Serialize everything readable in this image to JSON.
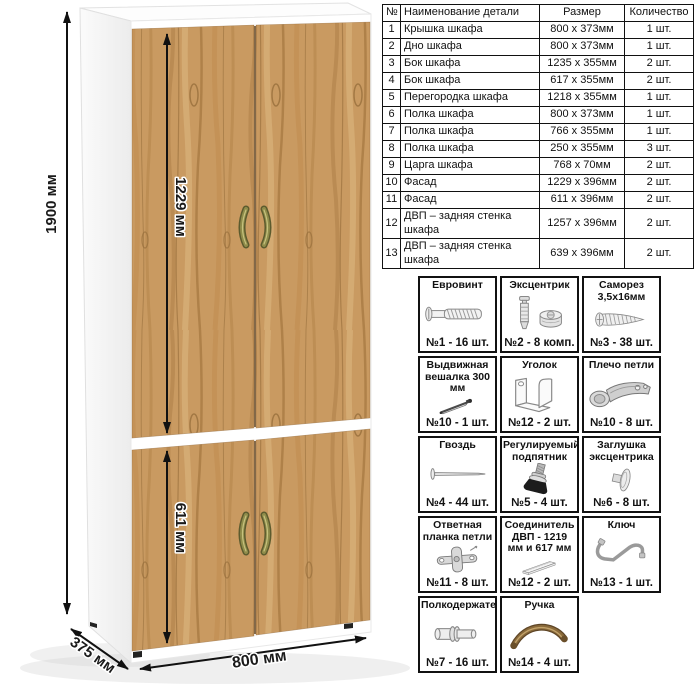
{
  "dimensions": {
    "height": "1900 мм",
    "upper_door": "1229 мм",
    "lower_door": "611 мм",
    "width": "800 мм",
    "depth": "375 мм"
  },
  "parts_table": {
    "headers": [
      "№",
      "Наименование детали",
      "Размер",
      "Количество"
    ],
    "rows": [
      [
        "1",
        "Крышка шкафа",
        "800 х 373мм",
        "1 шт."
      ],
      [
        "2",
        "Дно шкафа",
        "800 х 373мм",
        "1 шт."
      ],
      [
        "3",
        "Бок шкафа",
        "1235 х 355мм",
        "2 шт."
      ],
      [
        "4",
        "Бок шкафа",
        "617 х 355мм",
        "2 шт."
      ],
      [
        "5",
        "Перегородка шкафа",
        "1218 х 355мм",
        "1 шт."
      ],
      [
        "6",
        "Полка шкафа",
        "800 х 373мм",
        "1 шт."
      ],
      [
        "7",
        "Полка шкафа",
        "766 х 355мм",
        "1 шт."
      ],
      [
        "8",
        "Полка шкафа",
        "250 х 355мм",
        "3 шт."
      ],
      [
        "9",
        "Царга шкафа",
        "768 х 70мм",
        "2 шт."
      ],
      [
        "10",
        "Фасад",
        "1229 х 396мм",
        "2 шт."
      ],
      [
        "11",
        "Фасад",
        "611 х 396мм",
        "2 шт."
      ],
      [
        "12",
        "ДВП – задняя стенка шкафа",
        "1257 х 396мм",
        "2 шт."
      ],
      [
        "13",
        "ДВП – задняя стенка шкафа",
        "639 х 396мм",
        "2 шт."
      ]
    ]
  },
  "hardware": {
    "items": [
      {
        "title": "Евровинт",
        "count": "№1 - 16 шт.",
        "icon": "euroscrew"
      },
      {
        "title": "Эксцентрик",
        "count": "№2 - 8 комп.",
        "icon": "cam"
      },
      {
        "title": "Саморез 3,5х16мм",
        "count": "№3 - 38 шт.",
        "icon": "screw"
      },
      {
        "title": "Выдвижная вешалка 300 мм",
        "count": "№10 - 1 шт.",
        "icon": "hanger"
      },
      {
        "title": "Уголок",
        "count": "№12 - 2 шт.",
        "icon": "bracket"
      },
      {
        "title": "Плечо петли",
        "count": "№10 - 8 шт.",
        "icon": "hinge"
      },
      {
        "title": "Гвоздь",
        "count": "№4 - 44 шт.",
        "icon": "nail"
      },
      {
        "title": "Регулируемый подпятник",
        "count": "№5 - 4 шт.",
        "icon": "foot"
      },
      {
        "title": "Заглушка эксцентрика",
        "count": "№6 - 8 шт.",
        "icon": "cap"
      },
      {
        "title": "Ответная планка петли",
        "count": "№11 - 8 шт.",
        "icon": "plate"
      },
      {
        "title": "Соединитель ДВП - 1219 мм и 617 мм",
        "count": "№12 - 2 шт.",
        "icon": "strip"
      },
      {
        "title": "Ключ",
        "count": "№13 - 1 шт.",
        "icon": "key"
      },
      {
        "title": "Полкодержатель",
        "count": "№7 - 16 шт.",
        "icon": "pin"
      },
      {
        "title": "Ручка",
        "count": "№14 - 4 шт.",
        "icon": "handle"
      }
    ]
  },
  "colors": {
    "wood": "#c99a61",
    "wood_dark": "#a97b44",
    "handle_bronze": "#8f8c4a",
    "carcass": "#ffffff",
    "line": "#111111"
  }
}
